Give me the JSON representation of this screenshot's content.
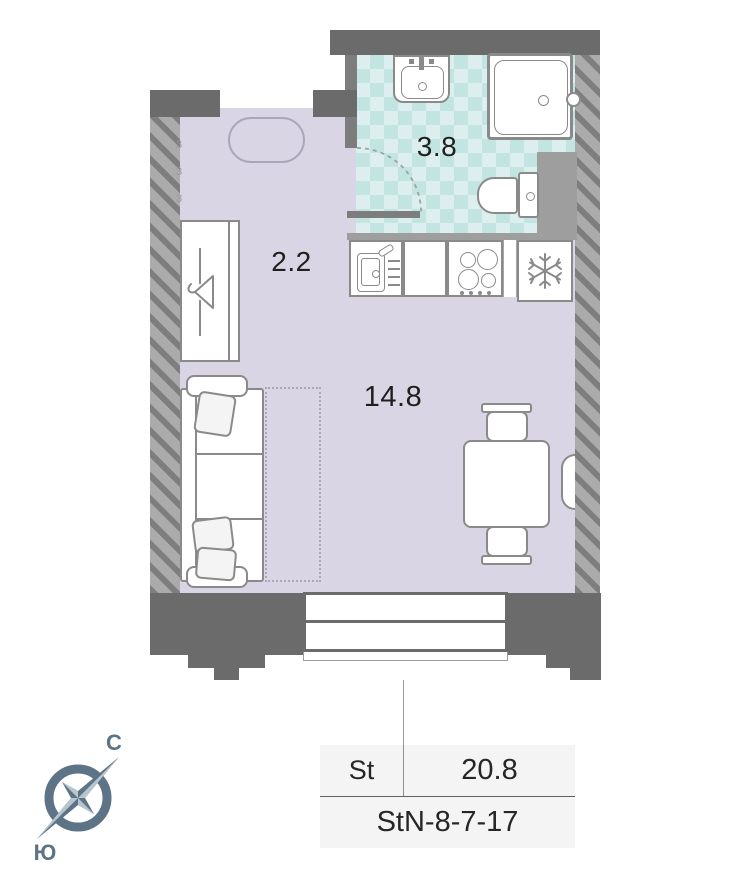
{
  "floorplan": {
    "title": "Studio apartment floor plan",
    "rooms": [
      {
        "id": "bathroom",
        "area_label": "3.8"
      },
      {
        "id": "hallway",
        "area_label": "2.2"
      },
      {
        "id": "living-room",
        "area_label": "14.8"
      }
    ],
    "info_table": {
      "type_label": "St",
      "total_area": "20.8",
      "unit_code": "StN-8-7-17"
    },
    "compass": {
      "north_label": "С",
      "south_label": "Ю"
    },
    "wall_marks": [
      "3",
      "3",
      "3"
    ],
    "colors": {
      "wall_dark": "#6b6b6b",
      "wall_hatch_base": "#ababab",
      "wall_hatch_stripe": "#7e7e7e",
      "floor_main": "#d9d5e5",
      "floor_bath_base": "#dceeed",
      "floor_bath_check": "#c3e5e2",
      "fixture_outline": "#8a8a8a",
      "label_text": "#1f1f1f",
      "table_bg": "#f4f4f4",
      "compass_dark": "#5d7386",
      "compass_light": "#b9c5cd"
    },
    "icons": {
      "bath_sink": "bath-sink-icon",
      "shower": "shower-tray-icon",
      "toilet": "toilet-icon",
      "kitchen_sink": "kitchen-sink-icon",
      "stove": "stove-burners-icon",
      "fridge": "fridge-snowflake-icon",
      "wardrobe": "wardrobe-hanger-icon",
      "sofa": "sofa-icon",
      "table": "dining-table-icon",
      "compass": "compass-rose-icon"
    }
  }
}
